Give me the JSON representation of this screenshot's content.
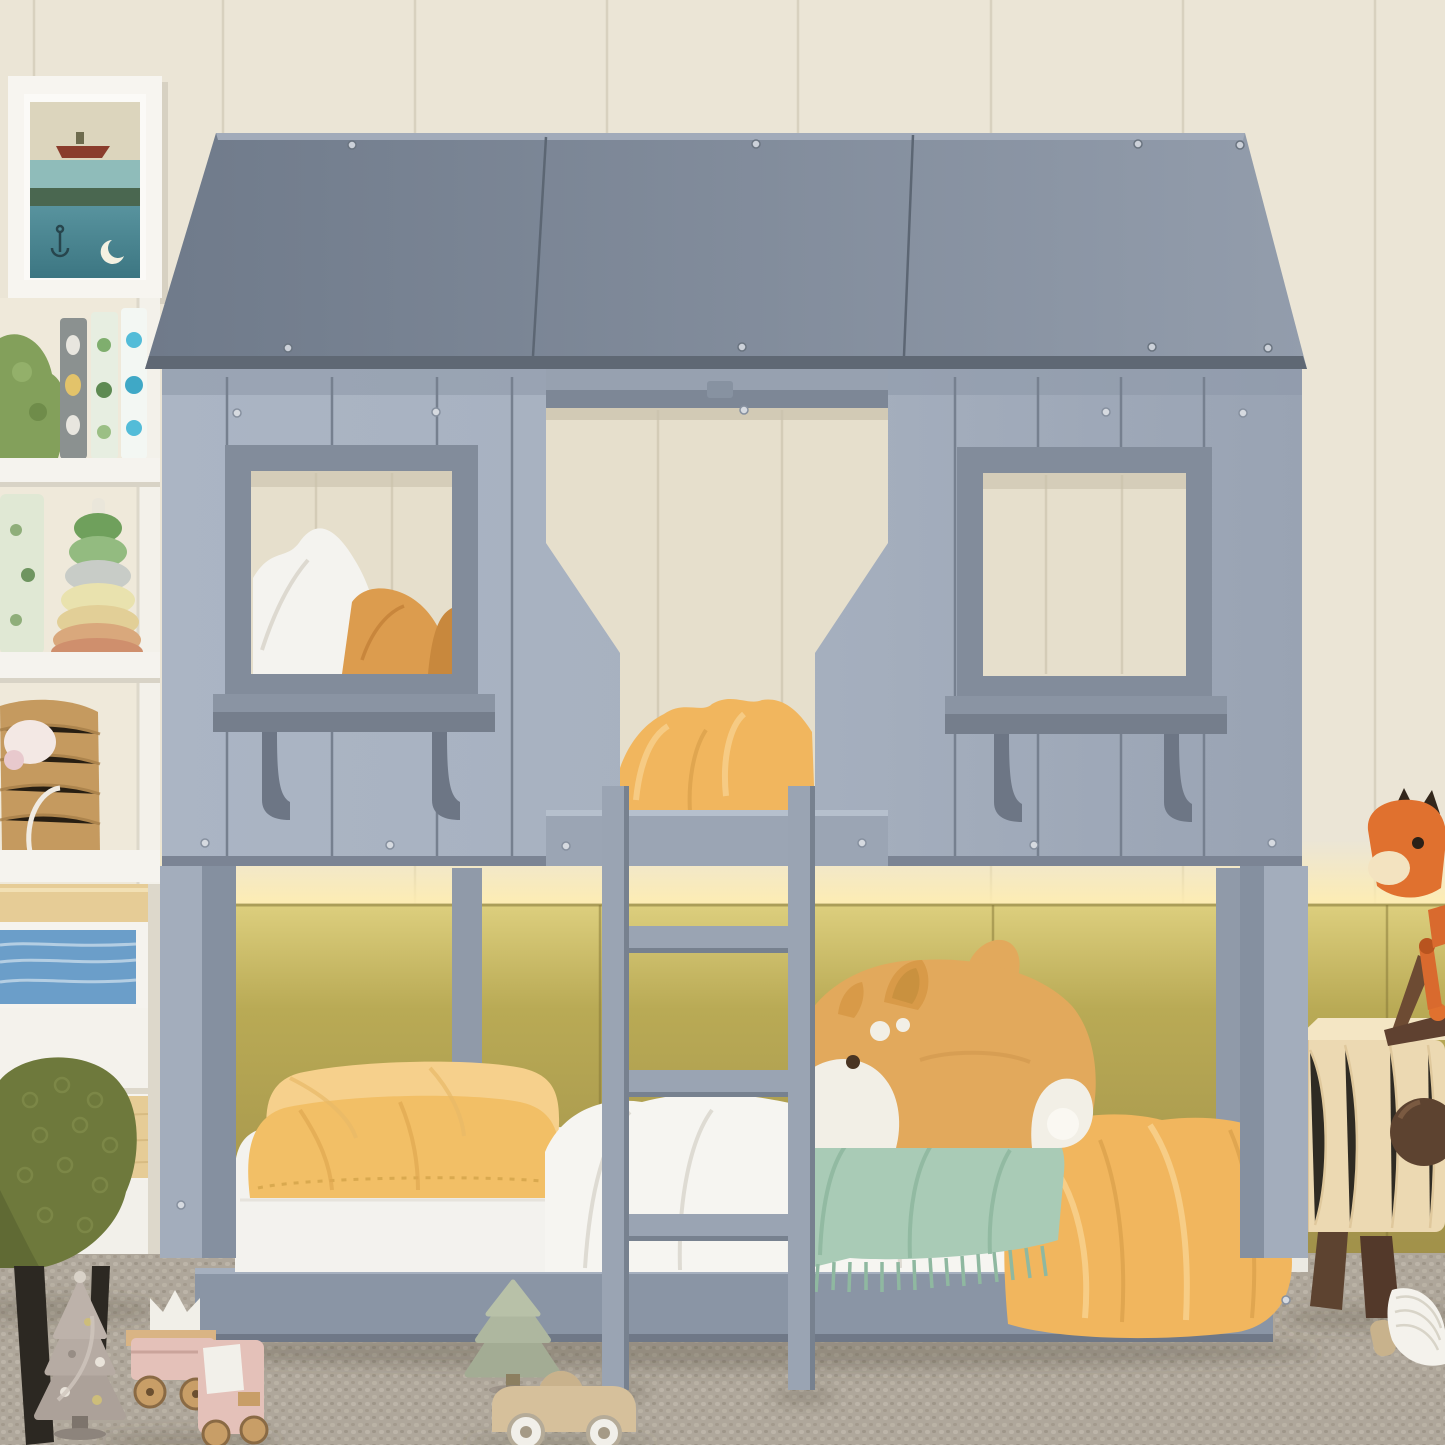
{
  "scene": {
    "description": "Children's bedroom with a gray house-shaped twin-over-twin low bunk bed. Paneled cream wall above, olive upholstered headboard panels with warm LED strip glow, gray woven carpet. Upper bunk seen through two square windows with shelves and a center door opening; ladder leans in front. Lower bunk has yellow pillows, white sheets, an orange duvet, a fringed green blanket and a large tan shiba plush. Left: framed sea artwork, white bookcase with picture books, stacking-ring toy and a basket, white-and-wood cabinet, green boucle chair. Right: light-wood nightstand with walnut legs, wooden horse toy parts and an orange dog-shaped lamp. Wooden toys on the floor.",
    "objects": [
      "house-bunk-bed",
      "roof",
      "left-window",
      "right-window",
      "door-opening",
      "ladder",
      "lower-bunk",
      "plush-shiba",
      "nightstand",
      "dog-lamp",
      "bookcase",
      "picture-frame",
      "green-chair",
      "floor-toys"
    ]
  },
  "colors": {
    "wall_cream": "#ebe5d6",
    "wall_seam": "#d8d1bf",
    "glow": "#ffedb0",
    "olive_top": "#ddcf7e",
    "olive": "#b9aa55",
    "olive_dark": "#a1914a",
    "carpet": "#b4ada1",
    "roof_dark": "#6f7a8a",
    "roof_light": "#939dac",
    "eave": "#5f6874",
    "body": "#a6b0bf",
    "body_shade": "#8d97a7",
    "groove": "#76808f",
    "frame_gray": "#828c9b",
    "interior": "#e6dfcc",
    "interior_seam": "#d4ccb7",
    "rail": "#9ba5b4",
    "post": "#a3adbc",
    "post_side": "#8590a0",
    "rear_post": "#909aa9",
    "ladder": "#9aa4b3",
    "base": "#8a95a5",
    "mattress": "#f3f2ee",
    "pillow_front": "#f2bf66",
    "pillow_back": "#f6d08c",
    "duvet": "#f1b65e",
    "duvet_light": "#f8d18d",
    "sheet": "#f6f5f1",
    "blanket_green": "#a9cbb6",
    "blanket_green_shade": "#8fb8a0",
    "plush_tan": "#e2a95c",
    "plush_white": "#f2efe6",
    "plush_dark": "#4a3523",
    "wood_light": "#e6cc96",
    "walnut": "#5d4330",
    "lamp_orange": "#e0712f",
    "lamp_lens": "#f3e3c0",
    "frame_white": "#f7f5f0",
    "art_sky": "#dcd5bd",
    "art_sea": "#8fbcba",
    "art_green": "#4a6750",
    "art_deep": "#3c7682",
    "art_boat": "#8a3c2c",
    "shelf_white": "#f5f3ee",
    "book_gray": "#8b9190",
    "book_green": "#e7eee1",
    "book_blue": "#f3f7f3",
    "basket": "#c59a5f",
    "cabinet_art_blue": "#6b9ec9",
    "chair_green": "#6e793c",
    "chair_leg": "#2c2822",
    "tree_gray": "#b0a59d",
    "tree_sage": "#a8b199",
    "train_pink": "#e4c1b9",
    "crown_white": "#f1efe8",
    "wheel_wood": "#c89e67",
    "car_wood": "#d6c09b",
    "wheel_white": "#f1efe9",
    "book_page": "#f4f2ec"
  }
}
